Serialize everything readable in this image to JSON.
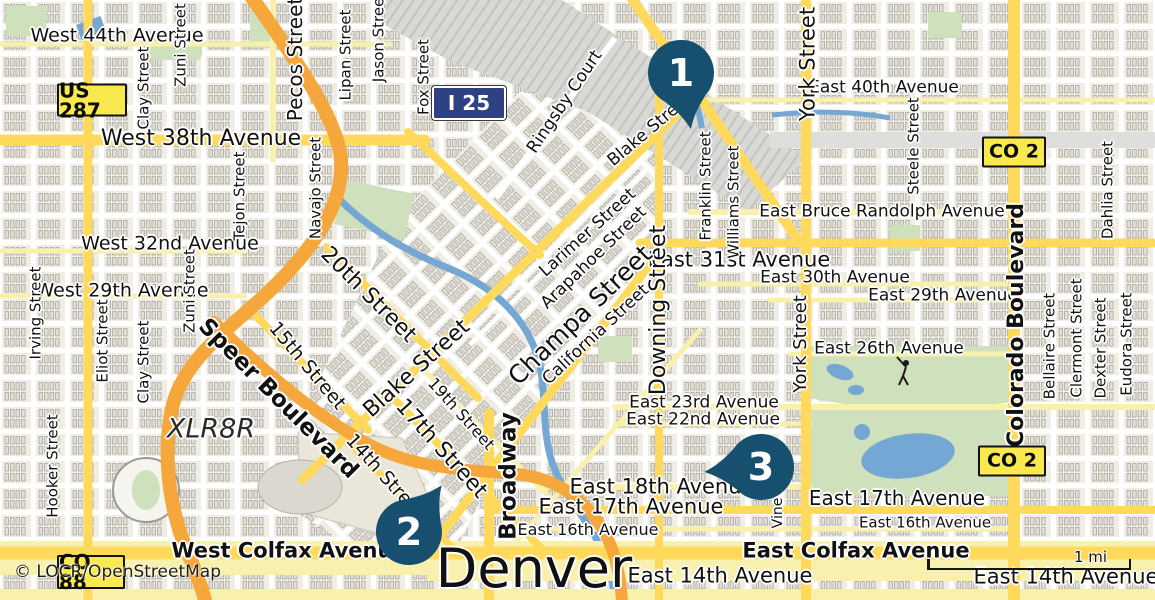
{
  "colors": {
    "land": "#F0EDE4",
    "label": "#111111",
    "marker": "#17506F",
    "road-primary": "#FFD95C",
    "road-minor": "#F9F0AC",
    "motorway": "#F5A73C",
    "water": "#74A7D4",
    "park-green": "#CFE0BC",
    "shield-yellow": "#F9E94E",
    "shield-blue": "#2E4183"
  },
  "map": {
    "attribution": "© LOCR/OpenStreetMap",
    "scale_label": "1 mi",
    "markers": [
      {
        "number": "1",
        "x": 681,
        "y": 73,
        "rot": -10
      },
      {
        "number": "2",
        "x": 409,
        "y": 532,
        "rot": 215
      },
      {
        "number": "3",
        "x": 761,
        "y": 467,
        "rot": 85
      }
    ],
    "shields": [
      {
        "label": "US 287",
        "style": "yellow",
        "x": 92,
        "y": 100,
        "w": 66,
        "h": 29,
        "fs": 20
      },
      {
        "label": "I 25",
        "style": "blue",
        "x": 469,
        "y": 103,
        "w": 70,
        "h": 30,
        "fs": 20
      },
      {
        "label": "CO 2",
        "style": "yellow",
        "x": 1014,
        "y": 152,
        "w": 60,
        "h": 27,
        "fs": 19
      },
      {
        "label": "CO 2",
        "style": "yellow",
        "x": 1012,
        "y": 461,
        "w": 64,
        "h": 27,
        "fs": 19
      },
      {
        "label": "CO 88",
        "style": "yellow",
        "x": 91,
        "y": 572,
        "w": 64,
        "h": 30,
        "fs": 20
      }
    ],
    "street_labels": [
      {
        "text": "West 44th Avenue",
        "x": 117,
        "y": 36,
        "size": 19
      },
      {
        "text": "West 38th Avenue",
        "x": 201,
        "y": 139,
        "size": 22
      },
      {
        "text": "East 40th Avenue",
        "x": 884,
        "y": 88,
        "size": 17
      },
      {
        "text": "East Bruce Randolph Avenue",
        "x": 882,
        "y": 212,
        "size": 17
      },
      {
        "text": "West 32nd Avenue",
        "x": 170,
        "y": 244,
        "size": 19
      },
      {
        "text": "West 29th Avenue",
        "x": 122,
        "y": 291,
        "size": 19
      },
      {
        "text": "East 31st Avenue",
        "x": 739,
        "y": 260,
        "size": 21
      },
      {
        "text": "East 30th Avenue",
        "x": 835,
        "y": 278,
        "size": 17
      },
      {
        "text": "East 29th Avenue",
        "x": 943,
        "y": 296,
        "size": 17
      },
      {
        "text": "East 26th Avenue",
        "x": 889,
        "y": 349,
        "size": 17
      },
      {
        "text": "East 23rd Avenue",
        "x": 704,
        "y": 403,
        "size": 17
      },
      {
        "text": "East 22nd Avenue",
        "x": 703,
        "y": 420,
        "size": 17
      },
      {
        "text": "East 18th Avenue",
        "x": 662,
        "y": 487,
        "size": 21
      },
      {
        "text": "East 17th Avenue",
        "x": 631,
        "y": 507,
        "size": 21
      },
      {
        "text": "East 17th Avenue",
        "x": 897,
        "y": 498,
        "size": 20
      },
      {
        "text": "East 16th Avenue",
        "x": 588,
        "y": 530,
        "size": 16
      },
      {
        "text": "East 16th Avenue",
        "x": 925,
        "y": 523,
        "size": 15
      },
      {
        "text": "West Colfax Avenue",
        "x": 289,
        "y": 551,
        "size": 21,
        "bold": true
      },
      {
        "text": "East Colfax Avenue",
        "x": 856,
        "y": 551,
        "size": 21,
        "bold": true
      },
      {
        "text": "East 14th Avenue",
        "x": 720,
        "y": 576,
        "size": 21
      },
      {
        "text": "East 14th Avenue",
        "x": 1066,
        "y": 577,
        "size": 21
      },
      {
        "text": "Denver",
        "x": 534,
        "y": 569,
        "size": 54
      },
      {
        "text": "XLR8R",
        "x": 211,
        "y": 429,
        "size": 27,
        "italic": true
      },
      {
        "text": "Zuni Street",
        "x": 181,
        "y": 45,
        "size": 15,
        "rot": -90
      },
      {
        "text": "Pecos Street",
        "x": 295,
        "y": 59,
        "size": 20,
        "rot": -90
      },
      {
        "text": "Lipan Street",
        "x": 346,
        "y": 55,
        "size": 15,
        "rot": -90
      },
      {
        "text": "Jason Street",
        "x": 379,
        "y": 37,
        "size": 15,
        "rot": -90
      },
      {
        "text": "Fox Street",
        "x": 424,
        "y": 77,
        "size": 15,
        "rot": -90
      },
      {
        "text": "Clay Street",
        "x": 144,
        "y": 88,
        "size": 15,
        "rot": -90
      },
      {
        "text": "Tejon Street",
        "x": 240,
        "y": 196,
        "size": 15,
        "rot": -90
      },
      {
        "text": "Navajo Street",
        "x": 316,
        "y": 188,
        "size": 15,
        "rot": -90
      },
      {
        "text": "York Street",
        "x": 808,
        "y": 64,
        "size": 21,
        "rot": -90
      },
      {
        "text": "Franklin Street",
        "x": 706,
        "y": 186,
        "size": 15,
        "rot": -90
      },
      {
        "text": "Williams Street",
        "x": 734,
        "y": 202,
        "size": 15,
        "rot": -90
      },
      {
        "text": "Steele Street",
        "x": 914,
        "y": 146,
        "size": 15,
        "rot": -90
      },
      {
        "text": "Dahlia Street",
        "x": 1108,
        "y": 190,
        "size": 15,
        "rot": -90
      },
      {
        "text": "Irving Street",
        "x": 36,
        "y": 313,
        "size": 15,
        "rot": -90
      },
      {
        "text": "Eliot Street",
        "x": 103,
        "y": 341,
        "size": 15,
        "rot": -90
      },
      {
        "text": "Clay Street",
        "x": 144,
        "y": 362,
        "size": 15,
        "rot": -90
      },
      {
        "text": "Zuni Street",
        "x": 190,
        "y": 291,
        "size": 15,
        "rot": -90
      },
      {
        "text": "Downing Street",
        "x": 659,
        "y": 310,
        "size": 22,
        "rot": -90
      },
      {
        "text": "York Street",
        "x": 801,
        "y": 344,
        "size": 18,
        "rot": -90
      },
      {
        "text": "Colorado Boulevard",
        "x": 1017,
        "y": 325,
        "size": 22,
        "rot": -90,
        "bold": true
      },
      {
        "text": "Bellaire Street",
        "x": 1050,
        "y": 346,
        "size": 15,
        "rot": -90
      },
      {
        "text": "Clermont Street",
        "x": 1077,
        "y": 338,
        "size": 15,
        "rot": -90
      },
      {
        "text": "Dexter Street",
        "x": 1101,
        "y": 348,
        "size": 15,
        "rot": -90
      },
      {
        "text": "Eudora Street",
        "x": 1127,
        "y": 344,
        "size": 15,
        "rot": -90
      },
      {
        "text": "Hooker Street",
        "x": 53,
        "y": 466,
        "size": 15,
        "rot": -90
      },
      {
        "text": "Broadway",
        "x": 509,
        "y": 476,
        "size": 23,
        "rot": -90,
        "bold": true
      },
      {
        "text": "Vine",
        "x": 778,
        "y": 513,
        "size": 14,
        "rot": -90
      },
      {
        "text": "Ringsby Court",
        "x": 565,
        "y": 102,
        "size": 17,
        "rot": -56
      },
      {
        "text": "Blake Street",
        "x": 650,
        "y": 130,
        "size": 17,
        "rot": -40
      },
      {
        "text": "20th Street",
        "x": 368,
        "y": 295,
        "size": 22,
        "rot": 45
      },
      {
        "text": "15th Street",
        "x": 307,
        "y": 366,
        "size": 19,
        "rot": 50
      },
      {
        "text": "Speer Boulevard",
        "x": 278,
        "y": 399,
        "size": 23,
        "rot": 45,
        "bold": true
      },
      {
        "text": "Blake Street",
        "x": 417,
        "y": 369,
        "size": 22,
        "rot": -42
      },
      {
        "text": "19th Street",
        "x": 461,
        "y": 414,
        "size": 16,
        "rot": 48
      },
      {
        "text": "17th Street",
        "x": 441,
        "y": 449,
        "size": 22,
        "rot": 48
      },
      {
        "text": "14th Street",
        "x": 385,
        "y": 477,
        "size": 19,
        "rot": 48
      },
      {
        "text": "Larimer Street",
        "x": 588,
        "y": 233,
        "size": 17,
        "rot": -42
      },
      {
        "text": "Arapahoe Street",
        "x": 594,
        "y": 258,
        "size": 17,
        "rot": -44
      },
      {
        "text": "Champa Street",
        "x": 580,
        "y": 315,
        "size": 25,
        "rot": -44
      },
      {
        "text": "California Street",
        "x": 596,
        "y": 335,
        "size": 17,
        "rot": -43
      }
    ]
  }
}
